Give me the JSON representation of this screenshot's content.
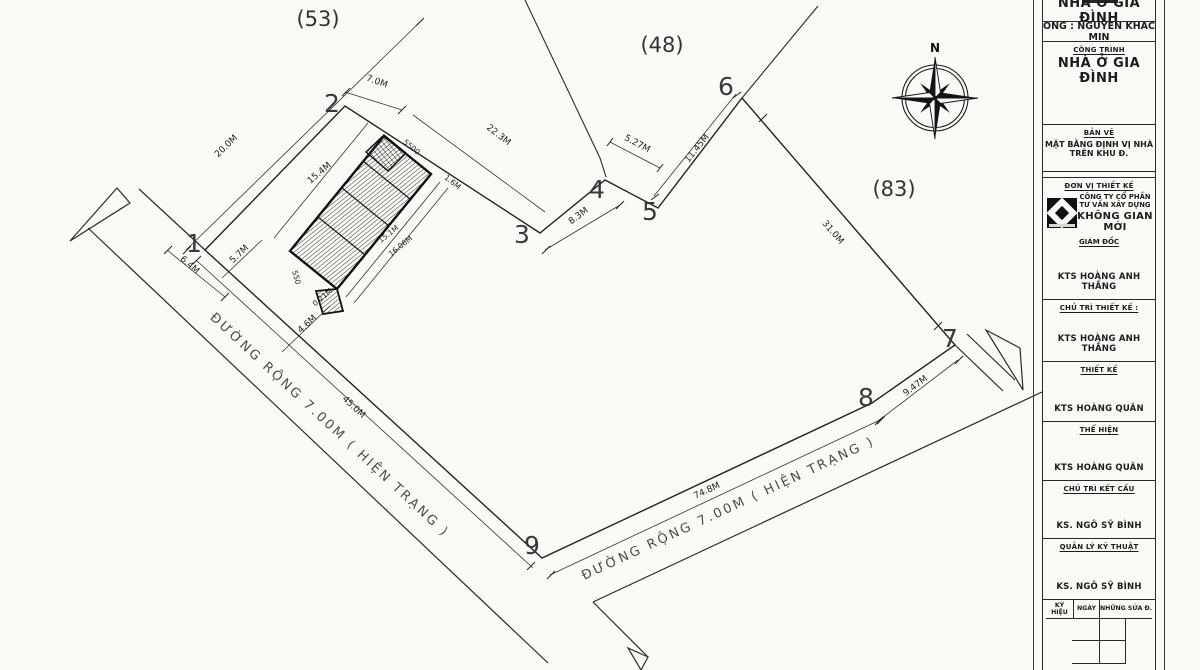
{
  "plan": {
    "parcels": [
      {
        "label": "(53)"
      },
      {
        "label": "(48)"
      },
      {
        "label": "(83)"
      }
    ],
    "vertices": [
      {
        "label": "1"
      },
      {
        "label": "2"
      },
      {
        "label": "3"
      },
      {
        "label": "4"
      },
      {
        "label": "5"
      },
      {
        "label": "6"
      },
      {
        "label": "7"
      },
      {
        "label": "8"
      },
      {
        "label": "9"
      }
    ],
    "roads": [
      {
        "label": "ĐƯỜNG RỘNG 7.00M ( HIỆN TRẠNG )"
      },
      {
        "label": "ĐƯỜNG RỘNG 7.00M ( HIỆN TRẠNG )"
      }
    ],
    "dimensions": [
      {
        "text": "20.0M"
      },
      {
        "text": "7.0M"
      },
      {
        "text": "22.3M"
      },
      {
        "text": "5500"
      },
      {
        "text": "1.6M"
      },
      {
        "text": "15.4M"
      },
      {
        "text": "15.1M"
      },
      {
        "text": "16.06M"
      },
      {
        "text": "550"
      },
      {
        "text": "0.21M"
      },
      {
        "text": "4.6M"
      },
      {
        "text": "5.7M"
      },
      {
        "text": "6.4M"
      },
      {
        "text": "8.3M"
      },
      {
        "text": "5.27M"
      },
      {
        "text": "11.45M"
      },
      {
        "text": "31.0M"
      },
      {
        "text": "9.47M"
      },
      {
        "text": "45.0M"
      },
      {
        "text": "74.8M"
      }
    ],
    "compass": {
      "north_label": "N"
    }
  },
  "title_block": {
    "owner": {
      "title": "NHÀ Ở GIA ĐÌNH",
      "name_line": "ÔNG : NGUYỄN KHẮC MIN"
    },
    "project": {
      "label": "CÔNG TRÌNH",
      "value": "NHÀ Ở GIA ĐÌNH"
    },
    "drawing": {
      "label": "BẢN VẼ",
      "value": "MẶT BẰNG ĐỊNH VỊ NHÀ TRÊN KHU Đ."
    },
    "design_unit": {
      "label": "ĐƠN VỊ THIẾT KẾ",
      "company": [
        "CÔNG TY CỔ PHẦN",
        "TƯ VẤN XÂY DỰNG",
        "KHÔNG GIAN MỚI"
      ]
    },
    "roles": [
      {
        "label": "GIÁM ĐỐC",
        "name": "KTS HOÀNG ANH THẮNG"
      },
      {
        "label": "CHỦ TRÌ THIẾT KẾ :",
        "name": "KTS HOÀNG ANH THẮNG"
      },
      {
        "label": "THIẾT KẾ",
        "name": "KTS HOÀNG QUÂN"
      },
      {
        "label": "THỂ HIỆN",
        "name": "KTS HOÀNG QUÂN"
      },
      {
        "label": "CHỦ TRÌ KẾT CẤU",
        "name": "KS. NGÔ SỸ BÌNH"
      },
      {
        "label": "QUẢN LÝ KỸ THUẬT",
        "name": "KS. NGÔ SỸ BÌNH"
      }
    ],
    "revision_table": {
      "col_symbol": "KÝ HIỆU",
      "col_date": "NGÀY",
      "col_changes": "NHỮNG SỬA Đ."
    }
  }
}
